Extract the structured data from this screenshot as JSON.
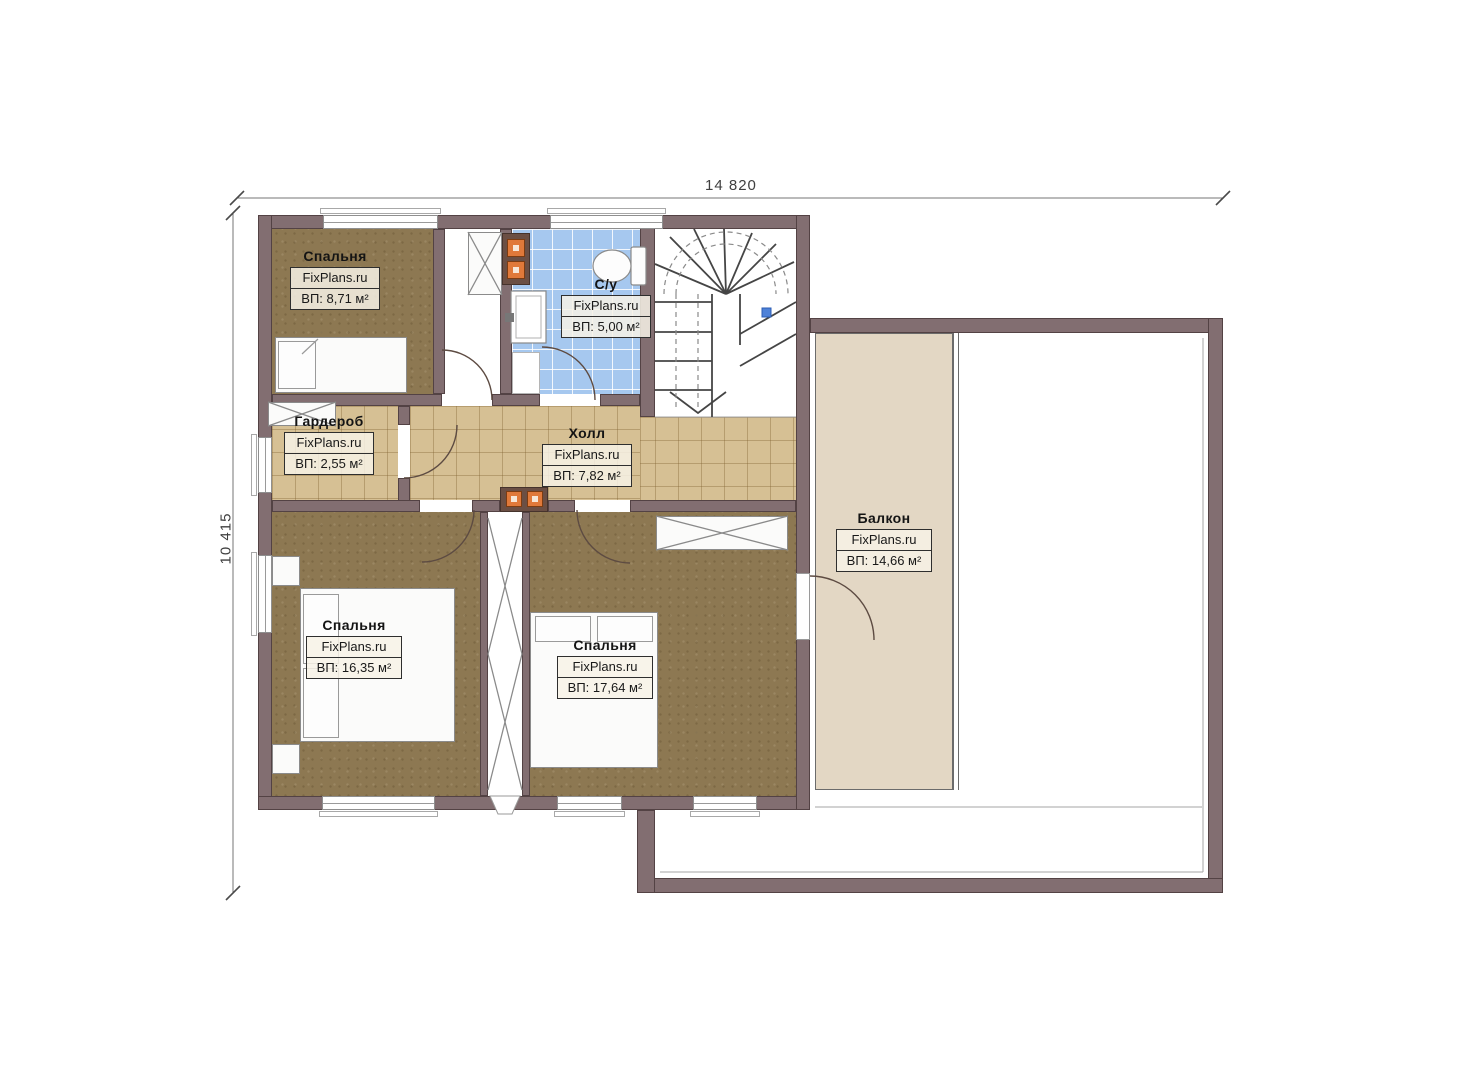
{
  "plan": {
    "dimensions": {
      "width_label": "14 820",
      "height_label": "10 415"
    },
    "rooms": [
      {
        "id": "bedroom-top",
        "name": "Спальня",
        "watermark": "FixPlans.ru",
        "area": "ВП: 8,71 м²"
      },
      {
        "id": "bathroom",
        "name": "С/у",
        "watermark": "FixPlans.ru",
        "area": "ВП: 5,00 м²"
      },
      {
        "id": "wardrobe",
        "name": "Гардероб",
        "watermark": "FixPlans.ru",
        "area": "ВП: 2,55 м²"
      },
      {
        "id": "hall",
        "name": "Холл",
        "watermark": "FixPlans.ru",
        "area": "ВП: 7,82 м²"
      },
      {
        "id": "balcony",
        "name": "Балкон",
        "watermark": "FixPlans.ru",
        "area": "ВП: 14,66 м²"
      },
      {
        "id": "bedroom-left",
        "name": "Спальня",
        "watermark": "FixPlans.ru",
        "area": "ВП: 16,35 м²"
      },
      {
        "id": "bedroom-right",
        "name": "Спальня",
        "watermark": "FixPlans.ru",
        "area": "ВП: 17,64 м²"
      }
    ],
    "colors": {
      "wall": "#826e71",
      "wall_edge": "#534244",
      "wood": "#8d7852",
      "tile": "#d6c094",
      "bath": "#a6c8ef",
      "balcony": "#e3d7c4",
      "orange": "#e0793a"
    }
  }
}
